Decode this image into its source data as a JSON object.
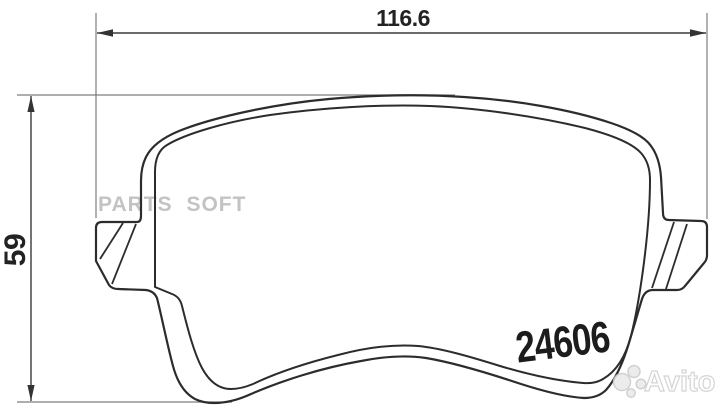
{
  "drawing": {
    "type": "technical-drawing",
    "subject": "brake-pad-backing-plate-outline",
    "part_number": "24606",
    "dimensions": {
      "width": "116.6",
      "height": "59"
    }
  },
  "watermarks": {
    "parts_soft": "PARTS SOFT",
    "avito_label": "Avito",
    "avito_logo_icon": "avito-four-dots-icon"
  },
  "colors": {
    "background": "#ffffff",
    "contour_line": "#2c2c2c",
    "dim_line": "#3a3a3a",
    "ext_line": "#7d7d7d",
    "arrow_fill": "#333333",
    "label_text": "#222222",
    "part_number_text": "#1c1c1c",
    "watermark_gray": "#c3c3c3",
    "avito_dot_fill": "#ebebeb",
    "avito_dot_edge": "#cccccc"
  }
}
